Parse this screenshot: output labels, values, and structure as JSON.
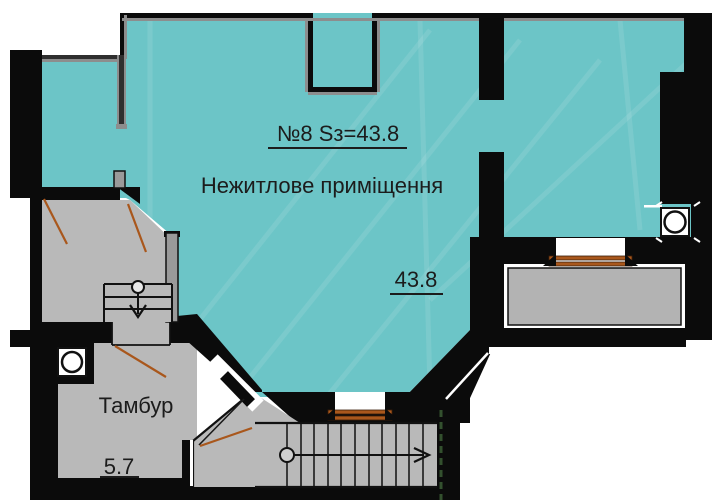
{
  "plan": {
    "type": "floor-plan",
    "labels": {
      "unit_label": "№8 Sз=43.8",
      "main_room_name": "Нежитлове приміщення",
      "main_room_area": "43.8",
      "vestibule_name": "Тамбур",
      "vestibule_area": "5.7"
    },
    "rooms": [
      {
        "name": "Нежитлове приміщення",
        "area": 43.8,
        "fill": "teal"
      },
      {
        "name": "Тамбур",
        "area": 5.7,
        "fill": "gray"
      }
    ],
    "symbols": [
      {
        "name": "ventilation-shaft",
        "count": 2
      },
      {
        "name": "staircase-with-direction-arrow",
        "count": 2
      },
      {
        "name": "door-leaf-with-swing-line",
        "count": 4
      },
      {
        "name": "window-sill",
        "count": 2
      },
      {
        "name": "balcony-slab",
        "count": 1
      }
    ],
    "colors": {
      "room_fill": "#6cc5c7",
      "floor_gray": "#b9b9b9",
      "balcony_gray": "#b3b3b3",
      "wall_black": "#0b0b0b",
      "partition_gray": "#8d8d8d",
      "window_sill_brown": "#a9571c",
      "stair_boundary_dash_green": "#33502e"
    }
  }
}
